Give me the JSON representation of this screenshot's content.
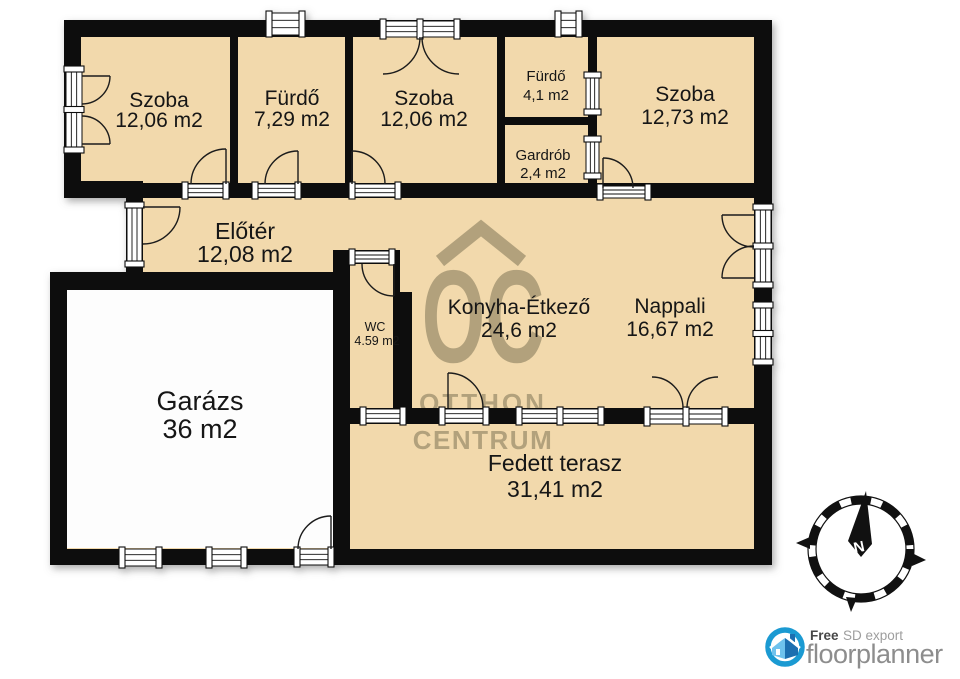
{
  "rooms": [
    {
      "name": "Szoba",
      "area": "12,06 m2"
    },
    {
      "name": "Fürdő",
      "area": "7,29 m2"
    },
    {
      "name": "Szoba",
      "area": "12,06 m2"
    },
    {
      "name": "Fürdő",
      "area": "4,1 m2"
    },
    {
      "name": "Gardrób",
      "area": "2,4 m2"
    },
    {
      "name": "Szoba",
      "area": "12,73 m2"
    },
    {
      "name": "Előtér",
      "area": "12,08 m2"
    },
    {
      "name": "Konyha-Étkező",
      "area": "24,6 m2"
    },
    {
      "name": "Nappali",
      "area": "16,67 m2"
    },
    {
      "name": "WC",
      "area": "4.59 m2"
    },
    {
      "name": "Garázs",
      "area": "36 m2"
    },
    {
      "name": "Fedett terasz",
      "area": "31,41 m2"
    }
  ],
  "watermark": {
    "monogram": "OC",
    "word1": "OTTHON",
    "word2": "CENTRUM"
  },
  "compass": {
    "north": "N"
  },
  "logo": {
    "free": "Free",
    "sd_export": "SD export",
    "brand": "floorplanner"
  },
  "colors": {
    "floor": "#f2d9ac",
    "garage_floor": "#fdfdfd",
    "wall": "#0e0e0e",
    "watermark": "#b2a17c",
    "logo_blue": "#1b9ad2",
    "logo_house_light": "#6fc2ed",
    "logo_house_dark": "#1d6fb0",
    "label_text": "#151515"
  }
}
